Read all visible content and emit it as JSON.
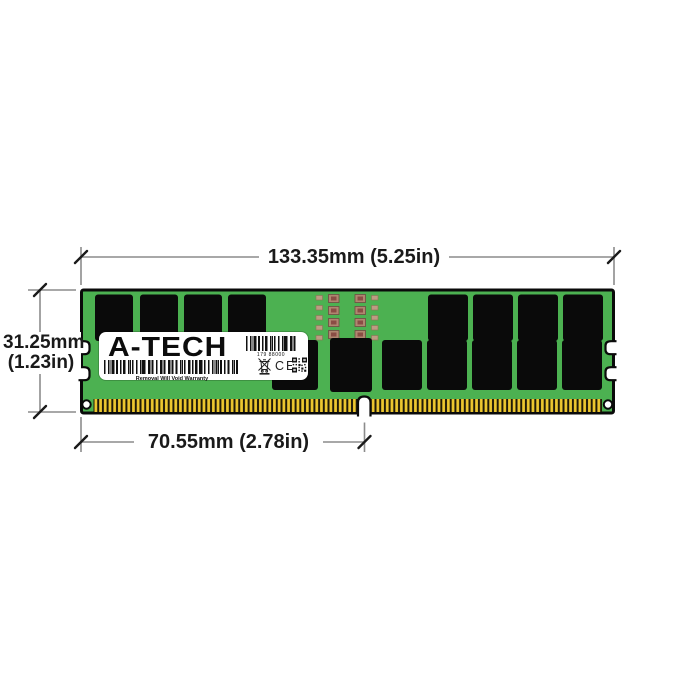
{
  "dimensions": {
    "width": {
      "label": "133.35mm (5.25in)"
    },
    "height": {
      "line1": "31.25mm",
      "line2": "(1.23in)"
    },
    "pin_span": {
      "label": "70.55mm (2.78in)"
    }
  },
  "label": {
    "brand": "A-TECH",
    "barcode_number": "179 88000",
    "warranty_text": "Removal Will Void Warranty",
    "ce_mark": "CE",
    "icons": [
      "barcode-icon",
      "weee-crossed-bin-icon",
      "ce-mark",
      "qr-code-icon"
    ]
  },
  "colors": {
    "pcb_green": "#4CB151",
    "chip_black": "#0A0A0A",
    "pin_gold": "#EDC72F",
    "pin_slot": "#201A08",
    "dimension_line": "#8C8C8C",
    "tick_and_text": "#1A1A1A",
    "label_white": "#FFFFFF"
  }
}
